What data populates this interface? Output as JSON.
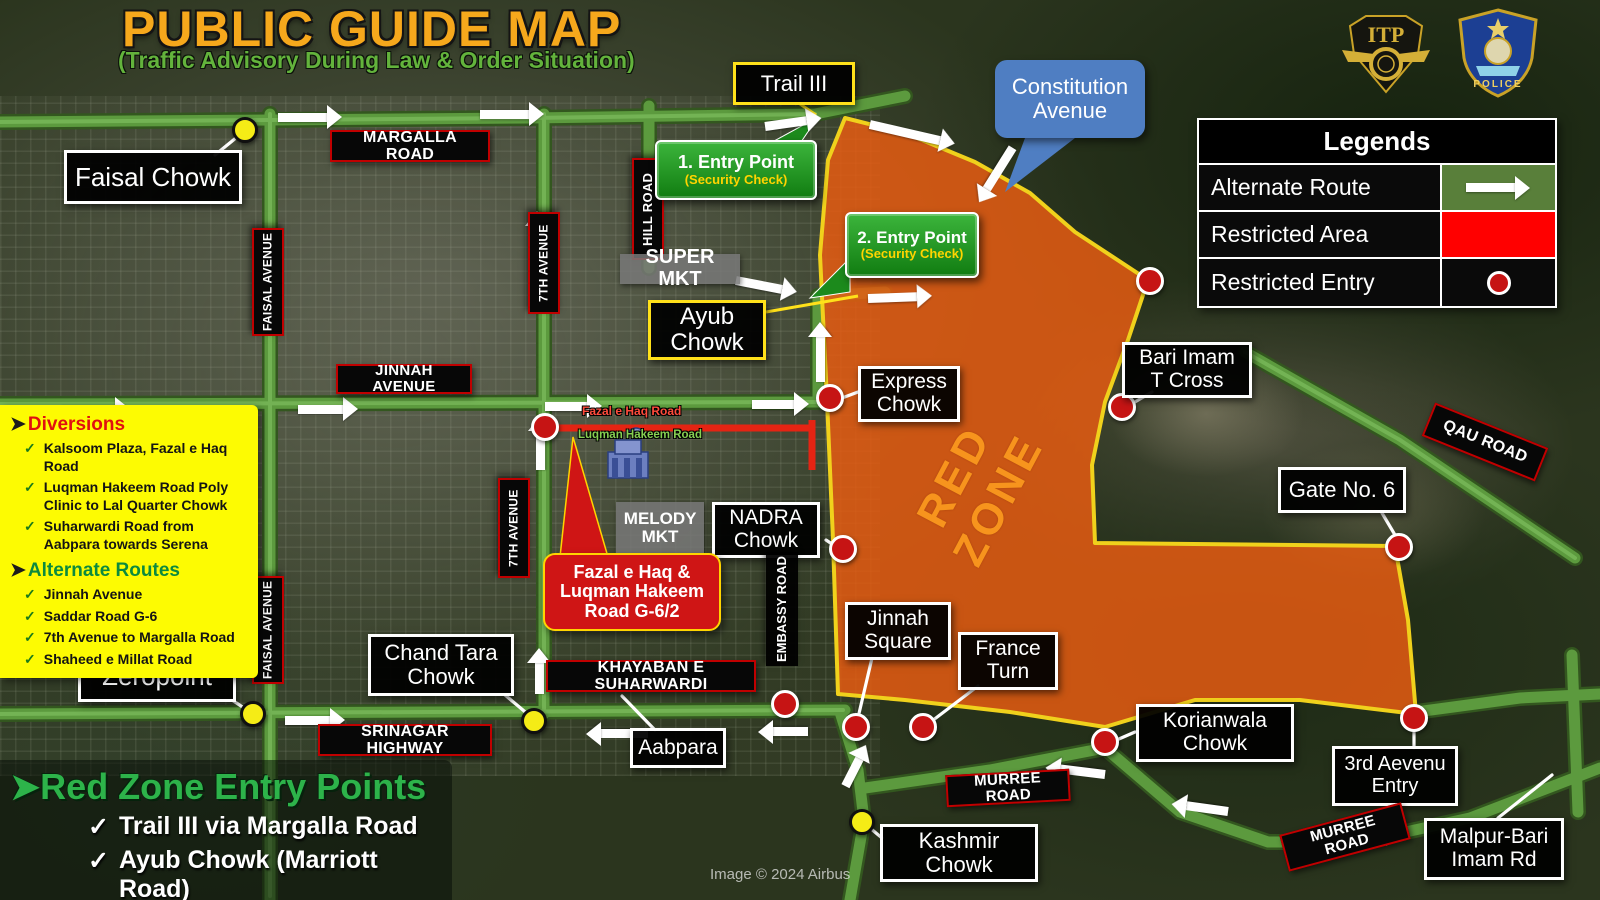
{
  "title": {
    "main": "PUBLIC GUIDE MAP",
    "subtitle": "(Traffic Advisory During Law & Order Situation)"
  },
  "logos": {
    "itp_text": "ITP",
    "ict_police_text": "POLICE"
  },
  "legends": {
    "title": "Legends",
    "rows": [
      {
        "label": "Alternate Route",
        "swatch": "green-arrow"
      },
      {
        "label": "Restricted Area",
        "swatch": "red-fill"
      },
      {
        "label": "Restricted Entry",
        "swatch": "red-circle"
      }
    ]
  },
  "diversions": {
    "heading": "Diversions",
    "items": [
      "Kalsoom Plaza, Fazal e Haq Road",
      "Luqman Hakeem Road Poly Clinic to Lal Quarter Chowk",
      "Suharwardi Road from Aabpara towards Serena"
    ],
    "alternate_heading": "Alternate Routes",
    "alternate_items": [
      "Jinnah Avenue",
      "Saddar Road G-6",
      "7th Avenue to Margalla Road",
      "Shaheed e Millat Road"
    ]
  },
  "red_zone_entry_points": {
    "heading": "Red Zone Entry Points",
    "items": [
      "Trail III via Margalla Road",
      "Ayub Chowk (Marriott Road)"
    ]
  },
  "entry_points": [
    {
      "title": "1. Entry Point",
      "subtitle": "(Security Check)"
    },
    {
      "title": "2. Entry Point",
      "subtitle": "(Security Check)"
    }
  ],
  "map_labels": {
    "trail3": "Trail III",
    "faisal_chowk": "Faisal Chowk",
    "margalla_road": "MARGALLA ROAD",
    "hill_road": "HILL ROAD",
    "faisal_avenue_upper": "FAISAL AVENUE",
    "faisal_avenue_lower": "FAISAL AVENUE",
    "seventh_avenue_upper": "7TH AVENUE",
    "seventh_avenue_lower": "7TH AVENUE",
    "super_mkt": "SUPER MKT",
    "ayub_chowk": "Ayub Chowk",
    "constitution_avenue": "Constitution Avenue",
    "express_chowk": "Express Chowk",
    "bari_imam": "Bari Imam T Cross",
    "jinnah_avenue": "JINNAH AVENUE",
    "red_zone": "RED ZONE",
    "qau_road": "QAU ROAD",
    "gate6": "Gate No. 6",
    "nadra_chowk": "NADRA Chowk",
    "melody_mkt": "MELODY MKT",
    "fazal_luqman_box": "Fazal e Haq & Luqman Hakeem Road G-6/2",
    "fazal_road": "Fazal e Haq Road",
    "luqman_road": "Luqman Hakeem Road",
    "embassy_road": "EMBASSY ROAD",
    "jinnah_square": "Jinnah Square",
    "france_turn": "France Turn",
    "khayaban": "KHAYABAN E SUHARWARDI",
    "chand_tara": "Chand Tara Chowk",
    "zeropoint": "Zeropoint",
    "srinagar": "SRINAGAR HIGHWAY",
    "aabpara": "Aabpara",
    "murree_center": "MURREE ROAD",
    "kashmir_chowk": "Kashmir Chowk",
    "korianwala": "Korianwala Chowk",
    "third_avenue_entry": "3rd Aevenu Entry",
    "murree_bottom_right": "MURREE ROAD",
    "malpur": "Malpur-Bari Imam Rd"
  },
  "icons": {
    "check": "✓",
    "bullet": "➤"
  },
  "colors": {
    "red_zone_fill": "#e65c12",
    "red_zone_border": "#f0d11c",
    "restricted_red": "#ff0000",
    "alternate_route_green": "#597f3a",
    "road_green": "#5c9a3e",
    "callout_blue": "#4f7ec2",
    "title_gold": "#f6a81c",
    "subtitle_green": "#63b33c",
    "diversion_panel_yellow": "#fdfb02"
  },
  "credit": "Image © 2024 Airbus"
}
